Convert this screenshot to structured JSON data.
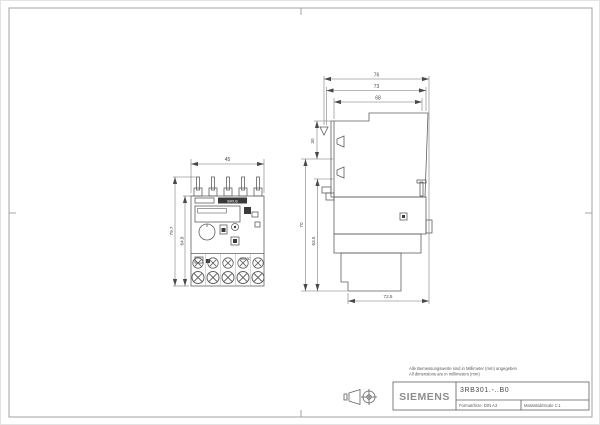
{
  "page": {
    "background": "#ffffff",
    "line_color": "#5f5f5f",
    "dark_fill": "#3a3a3a"
  },
  "notes": {
    "line1_de": "Alle Bemessungswerte sind in Millimeter (mm) angegeben",
    "line2_en": "All dimensions are in millimeters (mm)"
  },
  "title_block": {
    "brand": "SIEMENS",
    "part_number": "3RB301.-..B0",
    "format": "Format/Size: DIN A3",
    "scale": "Massstab/Scale 1:1"
  },
  "front_view": {
    "view_name": "front-view",
    "device_labels": {
      "top_bar": "SIRIUS",
      "model": "3RB30"
    },
    "dimensions": {
      "width": "45",
      "total_height": "79.7",
      "body_height": "64.8"
    }
  },
  "side_view": {
    "view_name": "side-view",
    "dimensions": {
      "overall_depth": "76",
      "upper_depth": "73",
      "inner_depth": "68",
      "top_section": "30",
      "lower_height": "70",
      "inner_height": "63.5",
      "bottom_depth": "72.5"
    }
  }
}
